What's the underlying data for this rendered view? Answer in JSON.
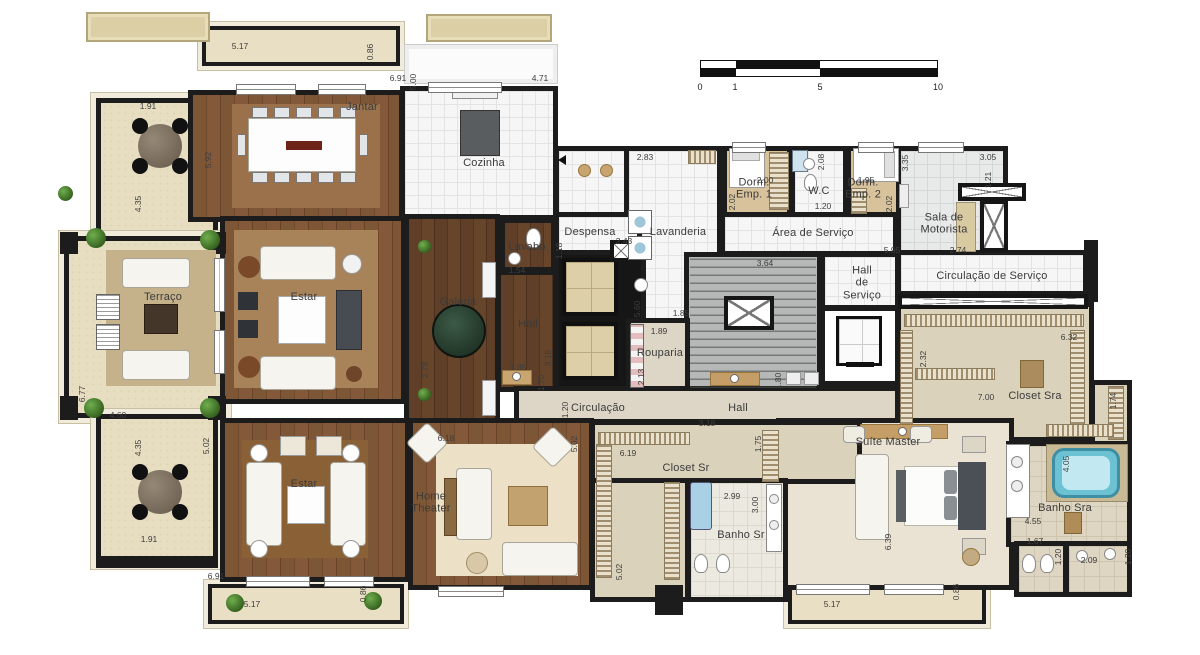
{
  "plan": {
    "labels": [
      {
        "text": "Jantar",
        "x": 362,
        "y": 107
      },
      {
        "text": "Cozinha",
        "x": 484,
        "y": 163
      },
      {
        "text": "Terraço",
        "x": 163,
        "y": 297
      },
      {
        "text": "Estar",
        "x": 304,
        "y": 297
      },
      {
        "text": "Estar",
        "x": 304,
        "y": 484
      },
      {
        "text": "Galeria",
        "x": 458,
        "y": 302
      },
      {
        "text": "Lavabo",
        "x": 527,
        "y": 247
      },
      {
        "text": "Despensa",
        "x": 590,
        "y": 232
      },
      {
        "text": "Lavanderia",
        "x": 678,
        "y": 232
      },
      {
        "text": "Dorm.\nEmp. 1",
        "x": 754,
        "y": 189
      },
      {
        "text": "W.C",
        "x": 819,
        "y": 191
      },
      {
        "text": "Dorm.\nEmp. 2",
        "x": 863,
        "y": 189
      },
      {
        "text": "Sala de\nMotorista",
        "x": 944,
        "y": 224
      },
      {
        "text": "Área de Serviço",
        "x": 813,
        "y": 233
      },
      {
        "text": "Hall\nde\nServiço",
        "x": 862,
        "y": 283
      },
      {
        "text": "Circulação de Serviço",
        "x": 992,
        "y": 276
      },
      {
        "text": "Hall",
        "x": 528,
        "y": 324
      },
      {
        "text": "Rouparia",
        "x": 660,
        "y": 353
      },
      {
        "text": "Circulação",
        "x": 598,
        "y": 408
      },
      {
        "text": "Hall",
        "x": 738,
        "y": 408
      },
      {
        "text": "Closet Sr",
        "x": 686,
        "y": 468
      },
      {
        "text": "Banho Sr",
        "x": 741,
        "y": 535
      },
      {
        "text": "Suíte Master",
        "x": 888,
        "y": 442
      },
      {
        "text": "Closet Sra",
        "x": 1035,
        "y": 396
      },
      {
        "text": "Banho Sra",
        "x": 1065,
        "y": 508
      },
      {
        "text": "Home\nTheater",
        "x": 431,
        "y": 503
      }
    ],
    "dims": [
      {
        "t": "5.17",
        "x": 240,
        "y": 46
      },
      {
        "t": "0.86",
        "x": 370,
        "y": 52,
        "v": 1
      },
      {
        "t": "6.91",
        "x": 398,
        "y": 78
      },
      {
        "t": "5.00",
        "x": 413,
        "y": 82,
        "v": 1
      },
      {
        "t": "4.71",
        "x": 540,
        "y": 78
      },
      {
        "t": "1.91",
        "x": 148,
        "y": 106
      },
      {
        "t": "5.92",
        "x": 208,
        "y": 160,
        "v": 1
      },
      {
        "t": "4.35",
        "x": 138,
        "y": 204,
        "v": 1
      },
      {
        "t": "2.83",
        "x": 645,
        "y": 157
      },
      {
        "t": "2.00",
        "x": 765,
        "y": 180
      },
      {
        "t": "2.02",
        "x": 732,
        "y": 202,
        "v": 1
      },
      {
        "t": "2.08",
        "x": 821,
        "y": 162,
        "v": 1
      },
      {
        "t": "1.20",
        "x": 823,
        "y": 206
      },
      {
        "t": "1.95",
        "x": 866,
        "y": 180
      },
      {
        "t": "2.02",
        "x": 889,
        "y": 204,
        "v": 1
      },
      {
        "t": "3.35",
        "x": 905,
        "y": 163,
        "v": 1
      },
      {
        "t": "3.05",
        "x": 988,
        "y": 157
      },
      {
        "t": "1.21",
        "x": 988,
        "y": 180,
        "v": 1
      },
      {
        "t": "5.95",
        "x": 892,
        "y": 250
      },
      {
        "t": "2.74",
        "x": 958,
        "y": 250
      },
      {
        "t": "2.43",
        "x": 624,
        "y": 241
      },
      {
        "t": "1.18",
        "x": 559,
        "y": 251,
        "v": 1
      },
      {
        "t": "1.54",
        "x": 517,
        "y": 270
      },
      {
        "t": "5.60",
        "x": 637,
        "y": 309,
        "v": 1
      },
      {
        "t": "3.64",
        "x": 765,
        "y": 263
      },
      {
        "t": "1.85",
        "x": 681,
        "y": 313
      },
      {
        "t": "1.89",
        "x": 659,
        "y": 331
      },
      {
        "t": "2.13",
        "x": 641,
        "y": 377,
        "v": 1
      },
      {
        "t": "1.80",
        "x": 778,
        "y": 381,
        "v": 1
      },
      {
        "t": "2.78",
        "x": 425,
        "y": 370,
        "v": 1
      },
      {
        "t": "1.85",
        "x": 518,
        "y": 367
      },
      {
        "t": "3.15",
        "x": 548,
        "y": 358,
        "v": 1
      },
      {
        "t": "1.70",
        "x": 541,
        "y": 383,
        "v": 1
      },
      {
        "t": "6.77",
        "x": 82,
        "y": 394,
        "v": 1
      },
      {
        "t": "4.60",
        "x": 118,
        "y": 415
      },
      {
        "t": "4.35",
        "x": 138,
        "y": 448,
        "v": 1
      },
      {
        "t": "1.91",
        "x": 149,
        "y": 539
      },
      {
        "t": "5.02",
        "x": 206,
        "y": 446,
        "v": 1
      },
      {
        "t": "6.91",
        "x": 216,
        "y": 576
      },
      {
        "t": "5.17",
        "x": 252,
        "y": 604
      },
      {
        "t": "0.86",
        "x": 363,
        "y": 594,
        "v": 1
      },
      {
        "t": "6.18",
        "x": 446,
        "y": 438
      },
      {
        "t": "5.02",
        "x": 574,
        "y": 444,
        "v": 1
      },
      {
        "t": "1.20",
        "x": 565,
        "y": 410,
        "v": 1
      },
      {
        "t": "3.18",
        "x": 707,
        "y": 423
      },
      {
        "t": "6.19",
        "x": 628,
        "y": 453
      },
      {
        "t": "1.75",
        "x": 758,
        "y": 444,
        "v": 1
      },
      {
        "t": "5.02",
        "x": 619,
        "y": 572,
        "v": 1
      },
      {
        "t": "2.99",
        "x": 732,
        "y": 496
      },
      {
        "t": "3.00",
        "x": 755,
        "y": 505,
        "v": 1
      },
      {
        "t": "2.32",
        "x": 923,
        "y": 359,
        "v": 1
      },
      {
        "t": "6.32",
        "x": 1069,
        "y": 337
      },
      {
        "t": "7.00",
        "x": 986,
        "y": 397
      },
      {
        "t": "1.74",
        "x": 1113,
        "y": 401,
        "v": 1
      },
      {
        "t": "6.39",
        "x": 888,
        "y": 542,
        "v": 1
      },
      {
        "t": "4.05",
        "x": 1066,
        "y": 464,
        "v": 1
      },
      {
        "t": "4.55",
        "x": 1033,
        "y": 521
      },
      {
        "t": "1.67",
        "x": 1035,
        "y": 541
      },
      {
        "t": "1.20",
        "x": 1058,
        "y": 557,
        "v": 1
      },
      {
        "t": "2.09",
        "x": 1089,
        "y": 560
      },
      {
        "t": "1.20",
        "x": 1128,
        "y": 557,
        "v": 1
      },
      {
        "t": "5.17",
        "x": 832,
        "y": 604
      },
      {
        "t": "0.86",
        "x": 956,
        "y": 592,
        "v": 1
      }
    ]
  },
  "scale_bar": {
    "ticks": [
      "0",
      "1",
      "5",
      "10"
    ]
  },
  "colors": {
    "wall": "#1c1c1c",
    "wood": "#7d5636",
    "wood_dark": "#5f3f27",
    "stone": "#e7ddc1",
    "tile": "#f6f6f6",
    "carpet": "#eae3d3",
    "closet": "#dbd2bc",
    "stair_gray": "#b6b8b8",
    "water_blue": "#6cc1d3",
    "plant_green": "#4d8a38",
    "rug_tan": "#a8835a"
  }
}
